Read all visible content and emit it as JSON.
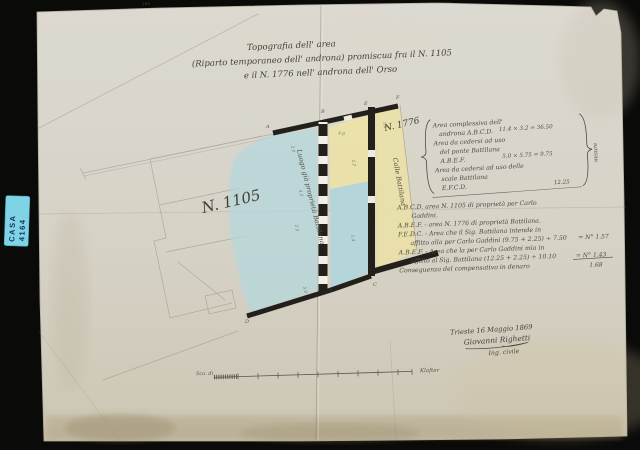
{
  "film_strip": {
    "frame_numbers": [
      "184",
      "185"
    ]
  },
  "sticker": {
    "top": "CASA",
    "bottom": "4164"
  },
  "title": {
    "line1": "Topografia dell' area",
    "line2": "(Riparto temporaneo dell' androna) promiscua fra il N. 1105",
    "line3": "e il N. 1776 nell' androna dell' Orso"
  },
  "plan": {
    "parcel_left": "N. 1105",
    "parcel_left_note": "Luogo già proprietà Battilana",
    "parcel_right": "N. 1776",
    "parcel_right_note": "Calle Battilana",
    "letters": {
      "a": "A",
      "b": "B",
      "c": "C",
      "d": "D",
      "e": "E",
      "f": "F"
    },
    "dimensions": [
      "2.0",
      "4.3",
      "2.5",
      "5.0",
      "4.0",
      "2.2",
      "1.4",
      "1.6"
    ]
  },
  "computation": {
    "lines": [
      "Area complessiva dell'",
      "androna A.B.C.D.",
      "Area da cedersi ad uso",
      "del ponte Battilana",
      "A.B.E.F.",
      "Area da cedersi ad uso delle",
      "scale Battilana",
      "E.F.C.D."
    ],
    "values": [
      "11.4 × 3.2 = 36.50",
      "5.0 × 5.75 = 9.75",
      "12.25"
    ],
    "side_note": "misure"
  },
  "legend": {
    "lines": [
      "A.B.C.D. area N. 1105 di proprietà per Carlo",
      "Gaddini.",
      "A.B.E.F. - area N. 1776 di proprietà Battilana.",
      "F.E.D.C. - Area che il Sig. Battilana intende in",
      "affitto alla per Carlo Gaddini (9.75 + 2.25) ÷ 7.50",
      "A.B.E.F. - Area che la per Carlo Gaddini mia in",
      "affitto al Sig. Battilana (12.25 + 2.25) ÷ 10.10",
      "Conseguenza del compensativo in denaro"
    ],
    "values": [
      "= N° 1.57",
      "= N° 1.43",
      "1.68"
    ]
  },
  "signature": {
    "place_date": "Trieste 16 Maggio 1869",
    "name": "Giovanni Righetti",
    "role": "Ing. civile"
  },
  "scale_bar": {
    "left_label": "Sca. di",
    "right_label": "Klafter"
  },
  "colors": {
    "backdrop": "#0a0a08",
    "paper": "#d8d5ca",
    "wash_blue": "#b3d8de",
    "wash_yellow": "#ece2a6",
    "wall": "#23201b",
    "sticker": "#7ed3e4",
    "ink": "#4f4b42"
  }
}
